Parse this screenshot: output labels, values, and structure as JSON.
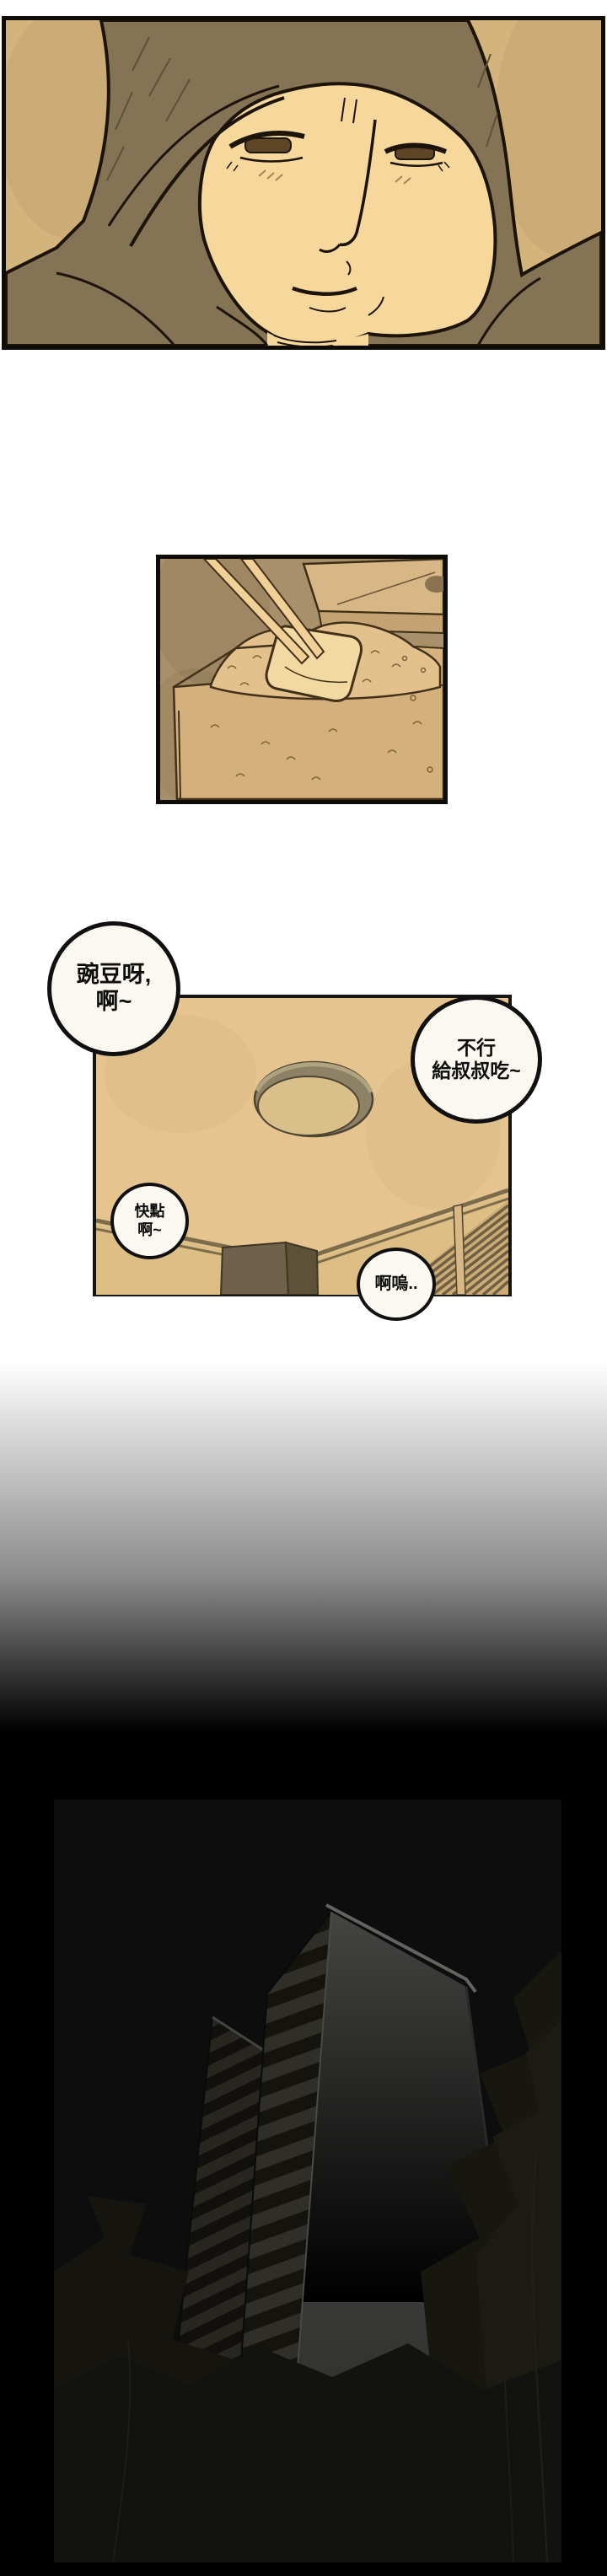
{
  "page": {
    "kind": "webtoon-comic-page",
    "sections": [
      "face-closeup-panel",
      "chopsticks-lunchbox-panel",
      "ceiling-dialogue-panel",
      "fade-to-black",
      "night-building-panel"
    ]
  },
  "bubbles": [
    {
      "lines": [
        "豌豆呀,",
        "啊~"
      ]
    },
    {
      "lines": [
        "不行",
        "給叔叔吃~"
      ]
    },
    {
      "lines": [
        "快點",
        "啊~"
      ]
    },
    {
      "lines": [
        "啊嗚.."
      ]
    }
  ],
  "colors": {
    "page_bg": "#ffffff",
    "ink_outline": "#1c1309",
    "panel_border": "#0f0c08",
    "sepia_background": "#d3b47c",
    "sepia_deep": "#a8906a",
    "skin": "#f6d89d",
    "hat_jacket": "#847455",
    "rice": "#e3c18d",
    "ceiling": "#e5c48f",
    "bubble_fill": "#fbf8f1",
    "bubble_text": "#0d0d0d",
    "night_black": "#000000",
    "night_panel_bg": "#0d0d0d",
    "building_wall": "#3f3f3d",
    "tree_silhouette": "#17160f"
  }
}
